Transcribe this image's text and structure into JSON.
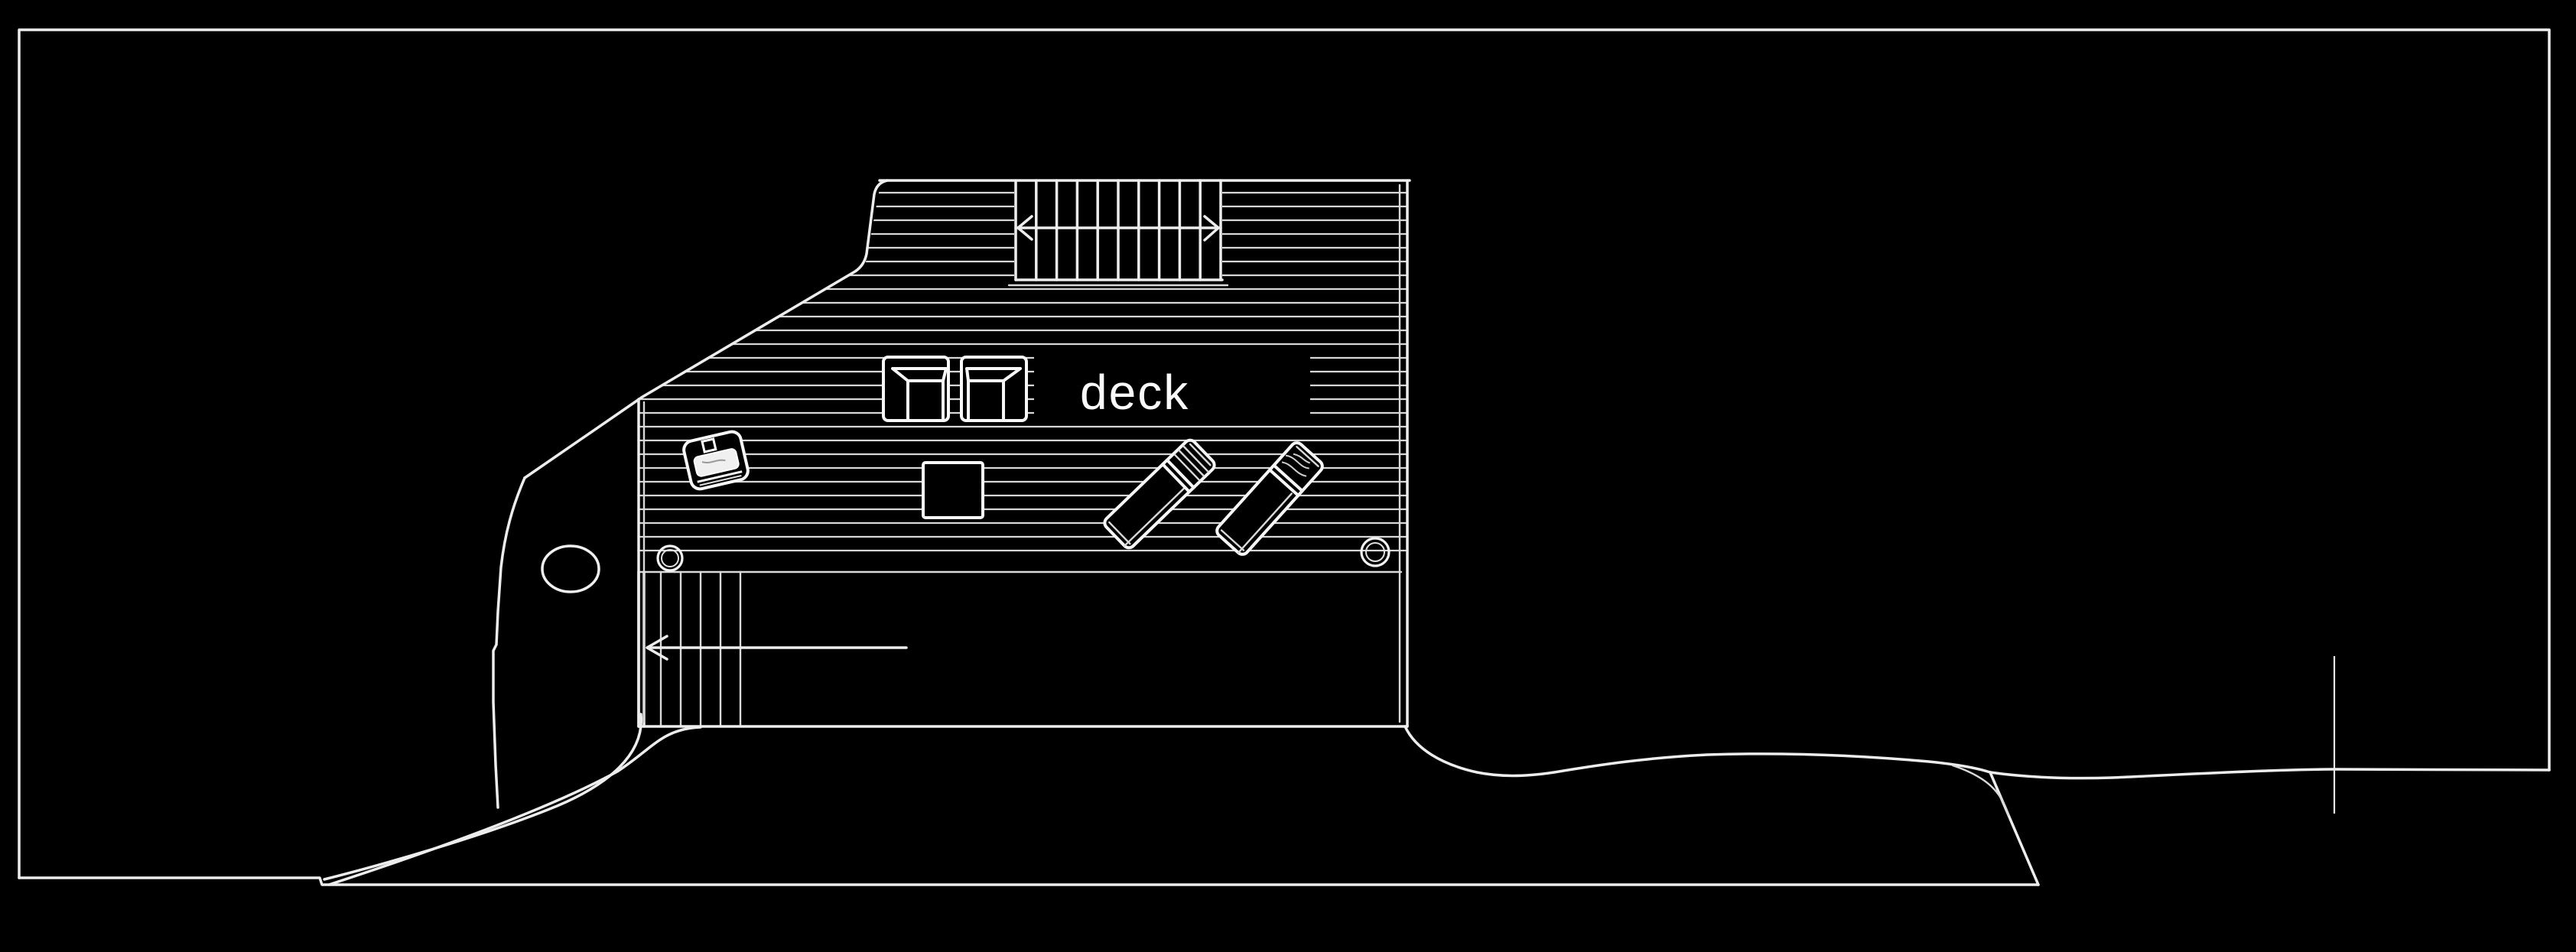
{
  "document": {
    "type": "architectural-site-plan",
    "style": "white line drawing on black background"
  },
  "deck": {
    "label": "deck"
  },
  "colors": {
    "background": "#000000",
    "line": "#ededed",
    "line_bright": "#f7f7f7",
    "hatch_line": "#d6d6d6",
    "label_text": "#fafafa"
  },
  "elements": {
    "border_frame": "drawing border frame",
    "deck_outline": "deck plan outline",
    "plank_hatching": "deck plank hatch lines",
    "upper_staircase": "staircase with double-headed direction arrow",
    "lower_staircase": "lower staircase to shore",
    "entry_arrow": "left-pointing entry arrow",
    "armchairs": "two plan-view armchairs",
    "side_table": "small square side table",
    "grill_cart": "rotated grill / serving tray",
    "sun_loungers": "two sun loungers rotated 45 degrees",
    "footing_circles": "two round footings on joist line",
    "rock_outline": "shore rock outline with ellipse marker",
    "boat_wedge": "tapering hull curves to shoreline",
    "terrain_line": "shoreline terrain contour",
    "cliff_line": "terrain drop line",
    "survey_tick": "vertical survey tick mark"
  }
}
